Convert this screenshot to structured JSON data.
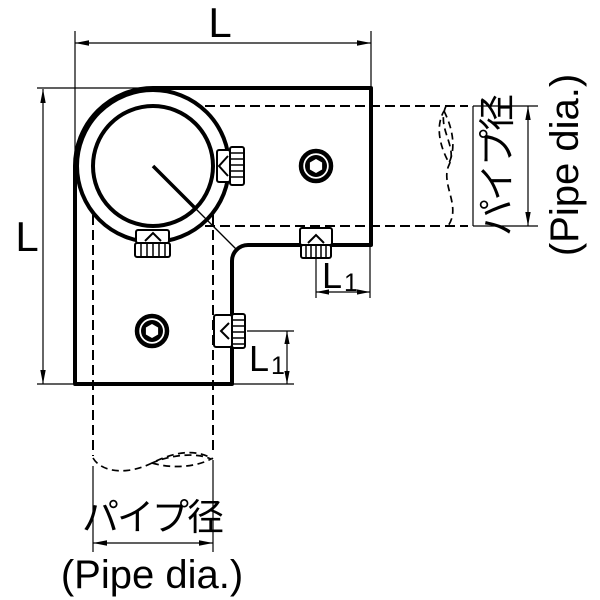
{
  "drawing": {
    "kind": "technical-drawing",
    "labels": {
      "top_L": "L",
      "left_L": "L",
      "right_L1": {
        "main": "L",
        "sub": "1"
      },
      "bottom_L1": {
        "main": "L",
        "sub": "1"
      },
      "right_pipe": {
        "jp": "パイプ径",
        "en": "(Pipe dia.)"
      },
      "bottom_pipe": {
        "jp": "パイプ径",
        "en": "(Pipe dia.)"
      }
    },
    "icons": {
      "set_screw_side": "knurled-set-screw-side-view",
      "set_screw_front": "hex-socket-set-screw-front-view",
      "pipe_break": "s-break-line",
      "hidden_line": "dashed-hidden-bore-line"
    },
    "colors": {
      "ink": "#000000",
      "background": "#ffffff"
    }
  }
}
